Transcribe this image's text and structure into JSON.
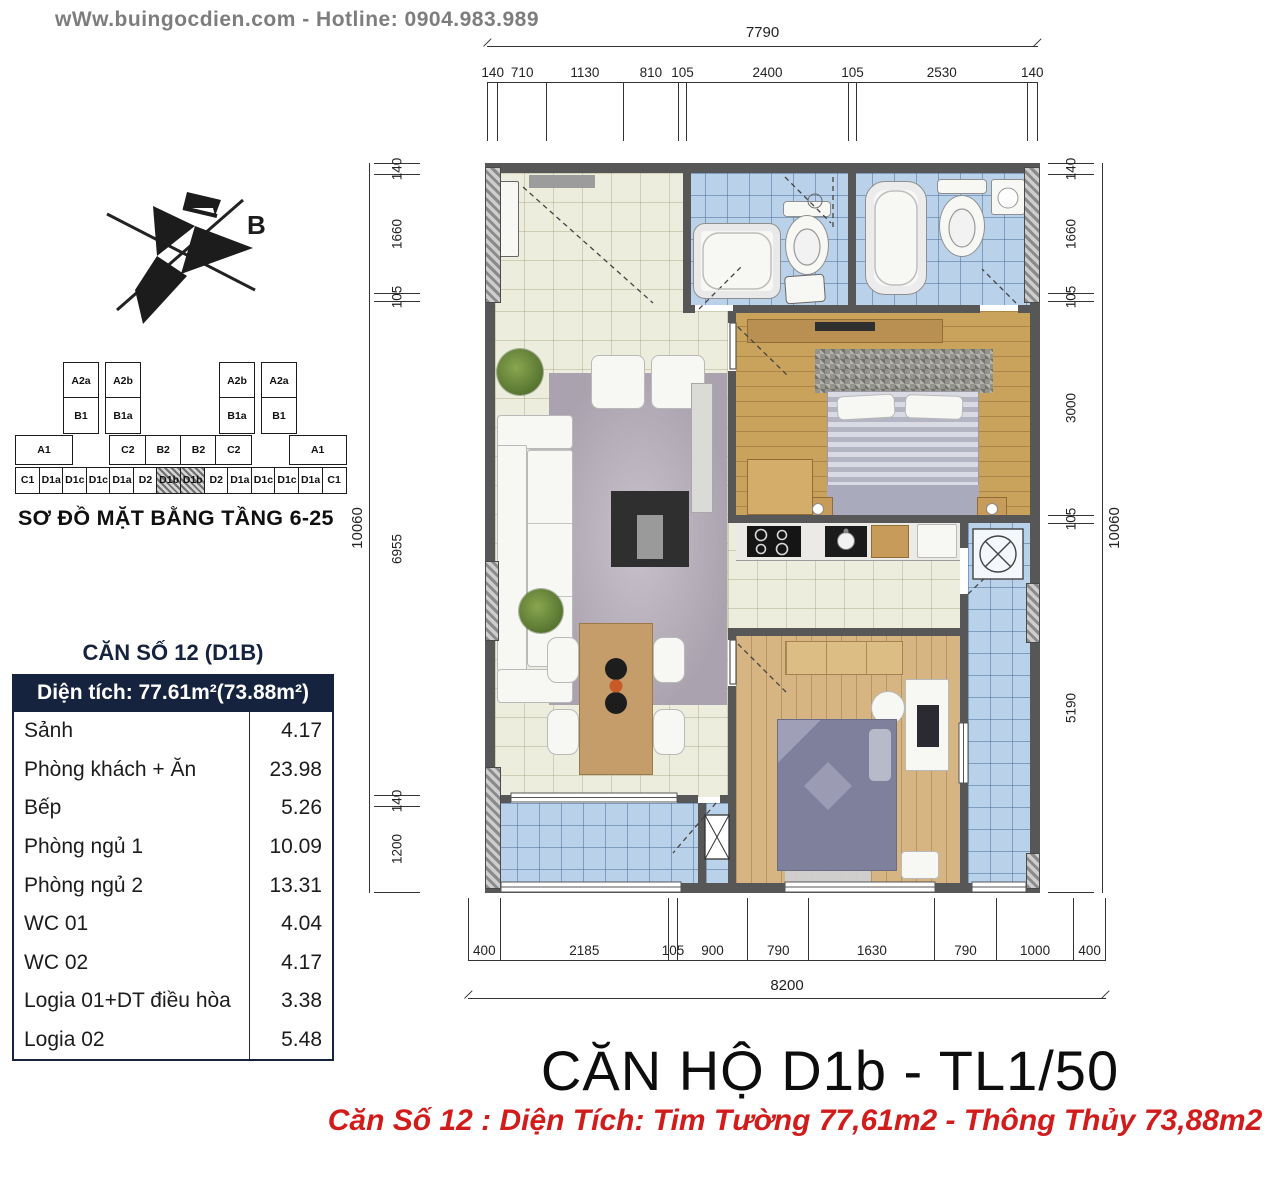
{
  "header": {
    "site_hotline": "wWw.buingocdien.com  -  Hotline: 0904.983.989"
  },
  "compass": {
    "north_label": "B"
  },
  "site_map": {
    "title": "SƠ ĐỒ MẶT BẰNG TẦNG 6-25",
    "highlighted_code": "D1b",
    "towers": {
      "left": [
        [
          "A2a",
          "B1"
        ],
        [
          "A2b",
          "B1a"
        ]
      ],
      "right": [
        [
          "A2b",
          "B1a"
        ],
        [
          "A2a",
          "B1"
        ]
      ]
    },
    "mid_left": [
      "A1"
    ],
    "mid_center": [
      "C2",
      "B2",
      "B2",
      "C2"
    ],
    "mid_right": [
      "A1"
    ],
    "bottom_row": [
      "C1",
      "D1a",
      "D1c",
      "D1c",
      "D1a",
      "D2",
      "D1b",
      "D1b",
      "D2",
      "D1a",
      "D1c",
      "D1c",
      "D1a",
      "C1"
    ]
  },
  "area_table": {
    "title": "CĂN SỐ 12 (D1B)",
    "header": "Diện tích: 77.61m²(73.88m²)",
    "rows": [
      {
        "label": "Sảnh",
        "value": "4.17"
      },
      {
        "label": "Phòng khách + Ăn",
        "value": "23.98"
      },
      {
        "label": "Bếp",
        "value": "5.26"
      },
      {
        "label": "Phòng ngủ 1",
        "value": "10.09"
      },
      {
        "label": "Phòng ngủ 2",
        "value": "13.31"
      },
      {
        "label": "WC 01",
        "value": "4.04"
      },
      {
        "label": "WC 02",
        "value": "4.17"
      },
      {
        "label": "Logia 01+DT điều hòa",
        "value": "3.38"
      },
      {
        "label": "Logia 02",
        "value": "5.48"
      }
    ]
  },
  "dimensions": {
    "top": {
      "total": "7790",
      "segments": [
        "140",
        "710",
        "1130",
        "810",
        "105",
        "2400",
        "105",
        "2530",
        "140"
      ]
    },
    "left": {
      "total": "10060",
      "segments": [
        "140",
        "1660",
        "105",
        "6955",
        "140",
        "1200"
      ]
    },
    "right": {
      "total": "10060",
      "segments": [
        "140",
        "1660",
        "105",
        "3000",
        "105",
        "5190"
      ]
    },
    "bottom": {
      "total": "8200",
      "segments": [
        "400",
        "2185",
        "105",
        "900",
        "790",
        "1630",
        "790",
        "1000",
        "400"
      ]
    }
  },
  "footer": {
    "title": "CĂN HỘ D1b - TL1/50",
    "subtitle": "Căn Số 12 : Diện Tích: Tim Tường 77,61m2 - Thông Thủy 73,88m2"
  },
  "colors": {
    "accent_navy": "#16233f",
    "accent_red": "#d21c1c",
    "wall_gray": "#575757",
    "tile_cream": "#eceddc",
    "tile_blue": "#b9d1e9",
    "wood": "#c9a25c",
    "header_gray": "#7d7d7d"
  }
}
